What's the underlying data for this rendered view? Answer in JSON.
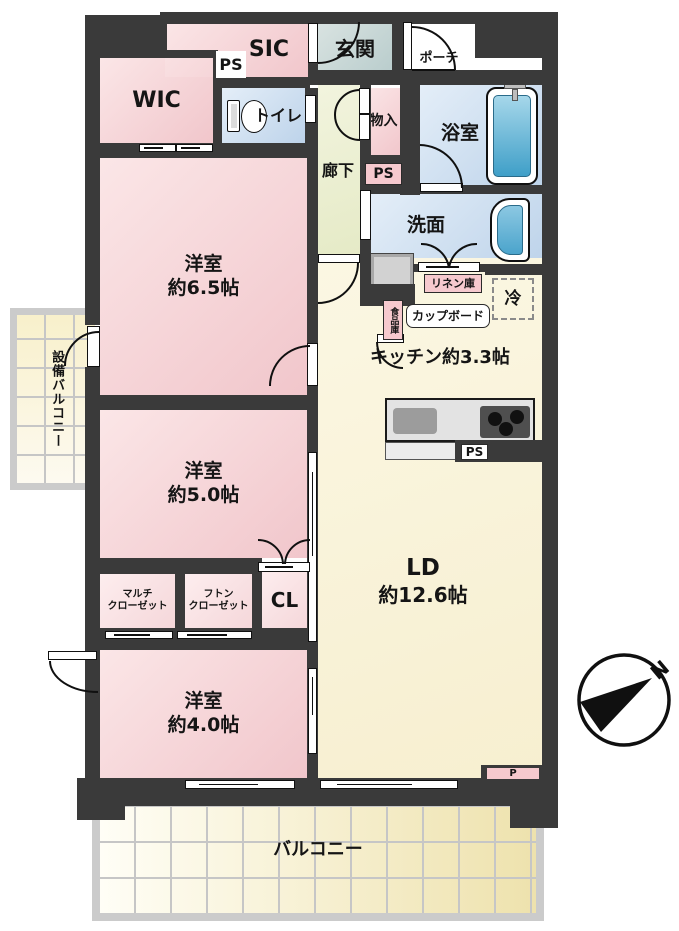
{
  "floorplan": {
    "rooms": {
      "wic": "WIC",
      "sic": "SIC",
      "genkan": "玄関",
      "porch": "ポーチ",
      "toilet": "トイレ",
      "storage": "物入",
      "corridor": "廊下",
      "bathroom": "浴室",
      "washroom": "洗面",
      "kitchen": {
        "name": "キッチン",
        "size": "約3.3帖"
      },
      "living": {
        "name": "LD",
        "size": "約12.6帖"
      },
      "bedroom1": {
        "name": "洋室",
        "size": "約6.5帖"
      },
      "bedroom2": {
        "name": "洋室",
        "size": "約5.0帖"
      },
      "bedroom3": {
        "name": "洋室",
        "size": "約4.0帖"
      },
      "multi_closet": "マルチ\nクローゼット",
      "futon_closet": "フトン\nクローゼット",
      "closet": "CL",
      "service_balcony": "設備バルコニー",
      "balcony": "バルコニー"
    },
    "fixtures": {
      "linen": "リネン庫",
      "cupboard": "カップボード",
      "pantry": "食品庫",
      "fridge": "冷"
    },
    "shafts": {
      "ps_top": "PS",
      "ps_hall": "PS",
      "ps_kitchen": "PS",
      "p_right": "P"
    },
    "compass_north": "N",
    "colors": {
      "wall": "#3a3a3a",
      "room_pink": "#f1c6cb",
      "room_blue": "#bdd3ea",
      "room_cream": "#f9f3d8",
      "corridor_green": "#e8ecca",
      "genkan_gray": "#c0d0d0",
      "balcony_tile": "#f0e5b2",
      "tub_blue": "#5eb3d8",
      "label_pink": "#f6c9ce"
    }
  }
}
